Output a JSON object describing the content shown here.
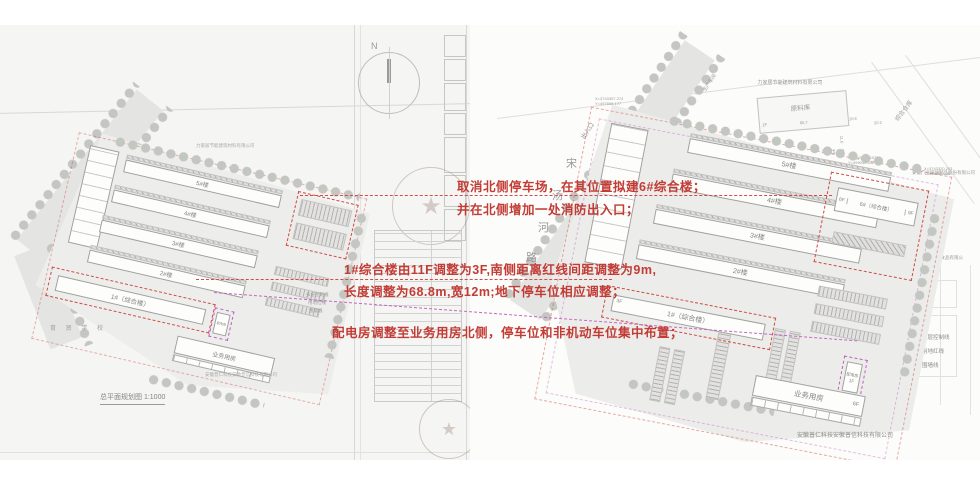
{
  "annotations": {
    "color": "#c23b35",
    "line1": "取消北侧停车场，在其位置拟建6#综合楼；",
    "line2": "并在北侧增加一处消防出入口；",
    "line3": "1#综合楼由11F调整为3F,南侧距离红线间距调整为9m,",
    "line4": "长度调整为68.8m,宽12m;地下停车位相应调整；",
    "line5": "配电房调整至业务用房北侧，停车位和非机动车位集中布置；"
  },
  "buildings": {
    "b5": "5#楼",
    "b4": "4#楼",
    "b3": "3#楼",
    "b2": "2#楼",
    "b1": "1#（综合楼）",
    "b6": "6#（综合楼）",
    "service": "业务用房",
    "power": "配电房"
  },
  "floors": {
    "b1_right": "3F",
    "b6_left": "6F",
    "b6_right": "9F",
    "service": "6F",
    "power": "1F",
    "material": "1F"
  },
  "legend": [
    "多层控制线",
    "用地红线",
    "围墙线"
  ],
  "left_plan": {
    "title": "总平面规划图 1:1000",
    "north_label": "N",
    "school": "育 贤 学 校",
    "company_top": "力家居节能建筑材料有限公司",
    "company_bottom": "安徽普仁科技安徽普信科技有限公司"
  },
  "right_plan": {
    "road_name": [
      "宋",
      "汤",
      "河",
      "路"
    ],
    "entrance": "出入口",
    "fire_exit": "消防出入口",
    "neighbors": {
      "top_company": "力家居节能建筑材料有限公司",
      "material_store": "原料库",
      "warehouse": "综合仓库",
      "workshop": "生产车间",
      "glass_company": "安徽广业玻璃制品股份有限公司",
      "food_company": "亳州市广告食品有限公司",
      "bottom_company": "安徽普仁科技安徽普信科技有限公司"
    },
    "coords": [
      {
        "x": "X=3743357.274",
        "y": "Y=497898.177"
      },
      {
        "x": "X=3743323.107",
        "y": "Y=499049.632"
      },
      {
        "x": "X=3743320.203",
        "y": "Y=499058.026"
      },
      {
        "x": "X=3743223.768",
        "y": "Y=497962.024"
      },
      {
        "x": "X=3743192.952",
        "y": "Y=497957.006"
      },
      {
        "x": "X=3743192.460",
        "y": "Y=498094.145"
      }
    ],
    "dims": {
      "d1": "86.7",
      "d2": "10.6",
      "d3": "20.2",
      "d4": "11.6"
    }
  },
  "icons": {
    "star": "★"
  }
}
